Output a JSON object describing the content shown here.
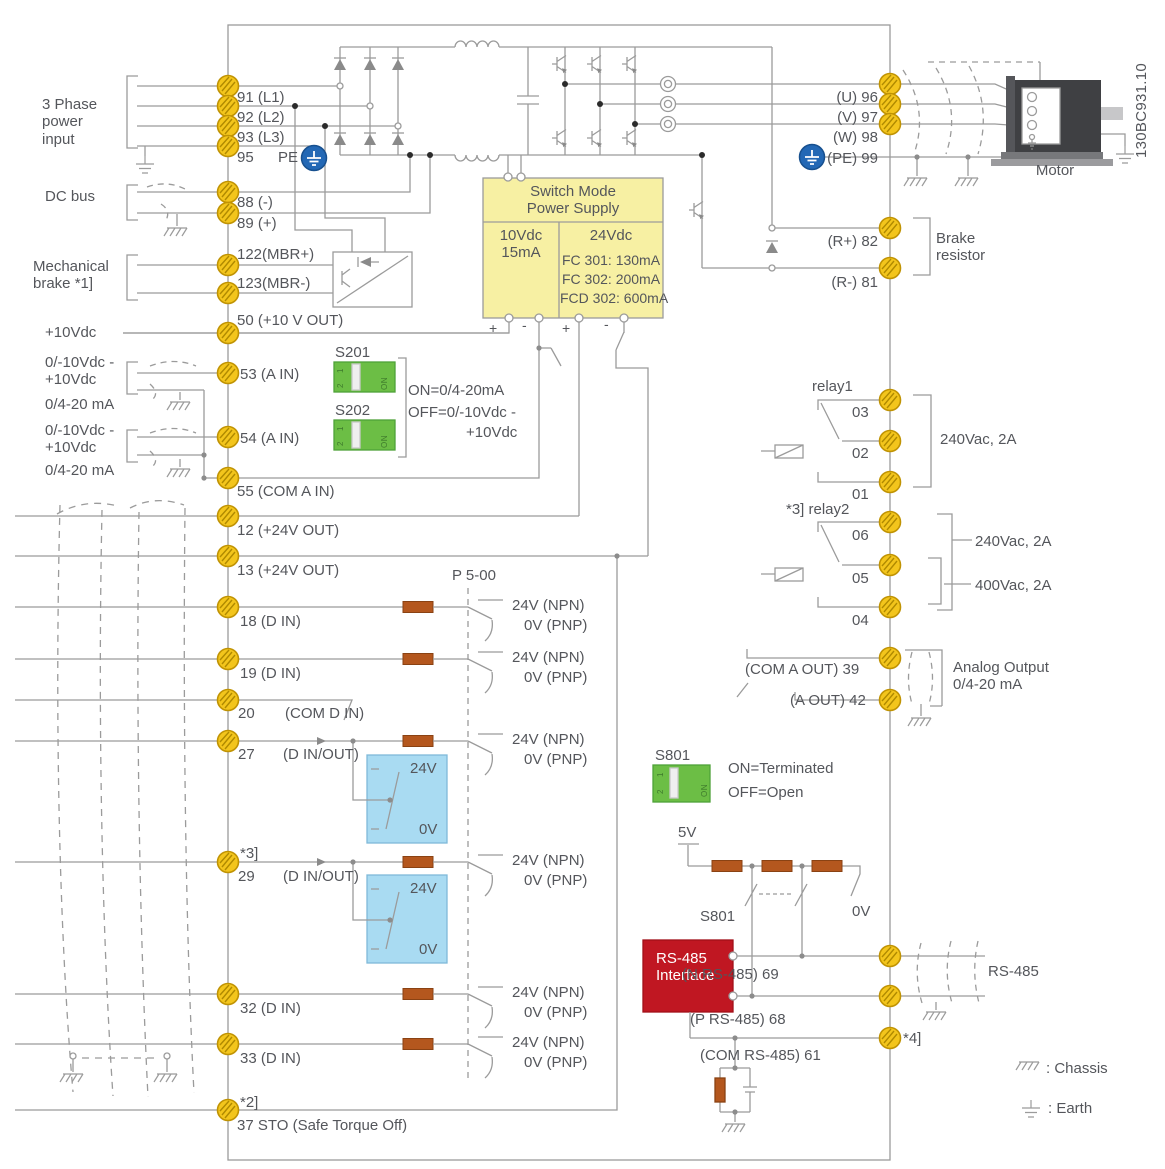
{
  "colors": {
    "terminal_yellow": "#F3C51C",
    "earth_blue": "#2368B5",
    "smps_yellow": "#F7F0A3",
    "dip_green": "#6CBE45",
    "resistor_orange": "#B4571E",
    "signal_box_blue": "#A9DBF2",
    "rs485_red": "#C01722",
    "wire_gray": "#9B9B9B",
    "text_gray": "#54565B"
  },
  "left_labels": {
    "power_input": "3 Phase\npower\ninput",
    "dc_bus": "DC bus",
    "mech_brake": "Mechanical\nbrake *1]",
    "v10_out": "+10Vdc",
    "ain53_range_v": "0/-10Vdc -\n+10Vdc",
    "ain53_range_i": "0/4-20 mA",
    "ain54_range_v": "0/-10Vdc -\n+10Vdc",
    "ain54_range_i": "0/4-20 mA"
  },
  "terminals": {
    "t91": "91 (L1)",
    "t92": "92 (L2)",
    "t93": "93 (L3)",
    "t95": "95",
    "pe": "PE",
    "t88": "88 (-)",
    "t89": "89 (+)",
    "t122": "122(MBR+)",
    "t123": "123(MBR-)",
    "t50": "50 (+10 V OUT)",
    "t53": "53 (A IN)",
    "t54": "54 (A IN)",
    "t55": "55 (COM A IN)",
    "t12": "12 (+24V OUT)",
    "t13": "13 (+24V OUT)",
    "t18": "18 (D IN)",
    "t19": "19 (D IN)",
    "t20": "20",
    "t20_com": "(COM D IN)",
    "t27": "27",
    "t27_io": "(D IN/OUT)",
    "note_3": "*3]",
    "t29": "29",
    "t29_io": "(D IN/OUT)",
    "t32": "32 (D IN)",
    "t33": "33 (D IN)",
    "note_2": "*2]",
    "t37": "37 STO (Safe Torque Off)"
  },
  "smps": {
    "title": "Switch Mode\nPower Supply",
    "cell_10v": "10Vdc\n15mA",
    "cell_24v": "24Vdc",
    "fc301": "FC 301: 130mA",
    "fc302": "FC 302: 200mA",
    "fcd302": "FCD 302: 600mA",
    "plus": "+",
    "minus": "-"
  },
  "switches": {
    "s201": "S201",
    "s202": "S202",
    "s201_on": "ON=0/4-20mA",
    "s201_off": "OFF=0/-10Vdc -",
    "s201_off2": "+10Vdc",
    "s801": "S801",
    "s801_on": "ON=Terminated",
    "s801_off": "OFF=Open",
    "s801_contact": "S801",
    "dip_on": "ON",
    "dip_1": "1",
    "dip_2": "2",
    "v5": "5V",
    "v0": "0V"
  },
  "digital": {
    "p500": "P 5-00",
    "npn": "24V (NPN)",
    "pnp": "0V (PNP)",
    "box_24v": "24V",
    "box_0v": "0V"
  },
  "right_labels": {
    "u96": "(U) 96",
    "v97": "(V) 97",
    "w98": "(W) 98",
    "pe99": "(PE) 99",
    "motor": "Motor",
    "doc_code": "130BC931.10",
    "r82": "(R+) 82",
    "r81": "(R-) 81",
    "brake_resistor": "Brake\nresistor",
    "relay1": "relay1",
    "c03": "03",
    "c02": "02",
    "c01": "01",
    "relay1_rating": "240Vac, 2A",
    "relay2": "*3] relay2",
    "c06": "06",
    "c05": "05",
    "c04": "04",
    "relay2_rating_240": "240Vac, 2A",
    "relay2_rating_400": "400Vac, 2A",
    "com_aout": "(COM A OUT) 39",
    "aout": "(A OUT) 42",
    "analog_output": "Analog Output\n0/4-20 mA",
    "n_rs485": "(N RS-485) 69",
    "p_rs485": "(P RS-485) 68",
    "com_rs485": "(COM RS-485) 61",
    "note_4": "*4]",
    "rs485_cable": "RS-485",
    "rs485_interface": "RS-485\nInterface"
  },
  "legend": {
    "chassis": ": Chassis",
    "earth": ": Earth"
  }
}
